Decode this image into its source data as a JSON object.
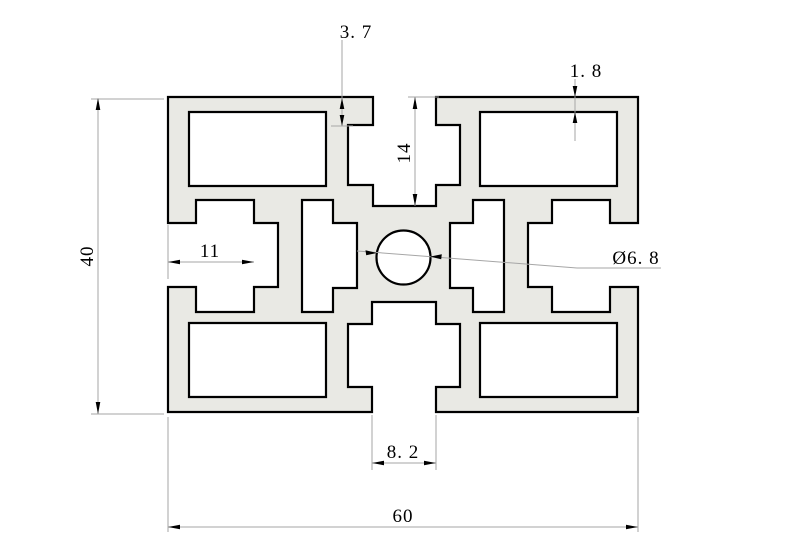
{
  "drawing": {
    "title": "aluminium-extrusion-profile-cross-section",
    "background": "#ffffff",
    "profile_fill": "#e9e9e4",
    "outline_color": "#000000",
    "dimension_line_color": "#a6a6a6",
    "text_color": "#000000",
    "dimensions": {
      "slot_lip_depth": "3. 7",
      "top_wall_thickness": "1. 8",
      "slot_total_depth": "14",
      "side_slot_depth": "11",
      "center_hole_diameter": "Ø6. 8",
      "slot_opening_width": "8. 2",
      "overall_width": "60",
      "overall_height": "40"
    }
  }
}
